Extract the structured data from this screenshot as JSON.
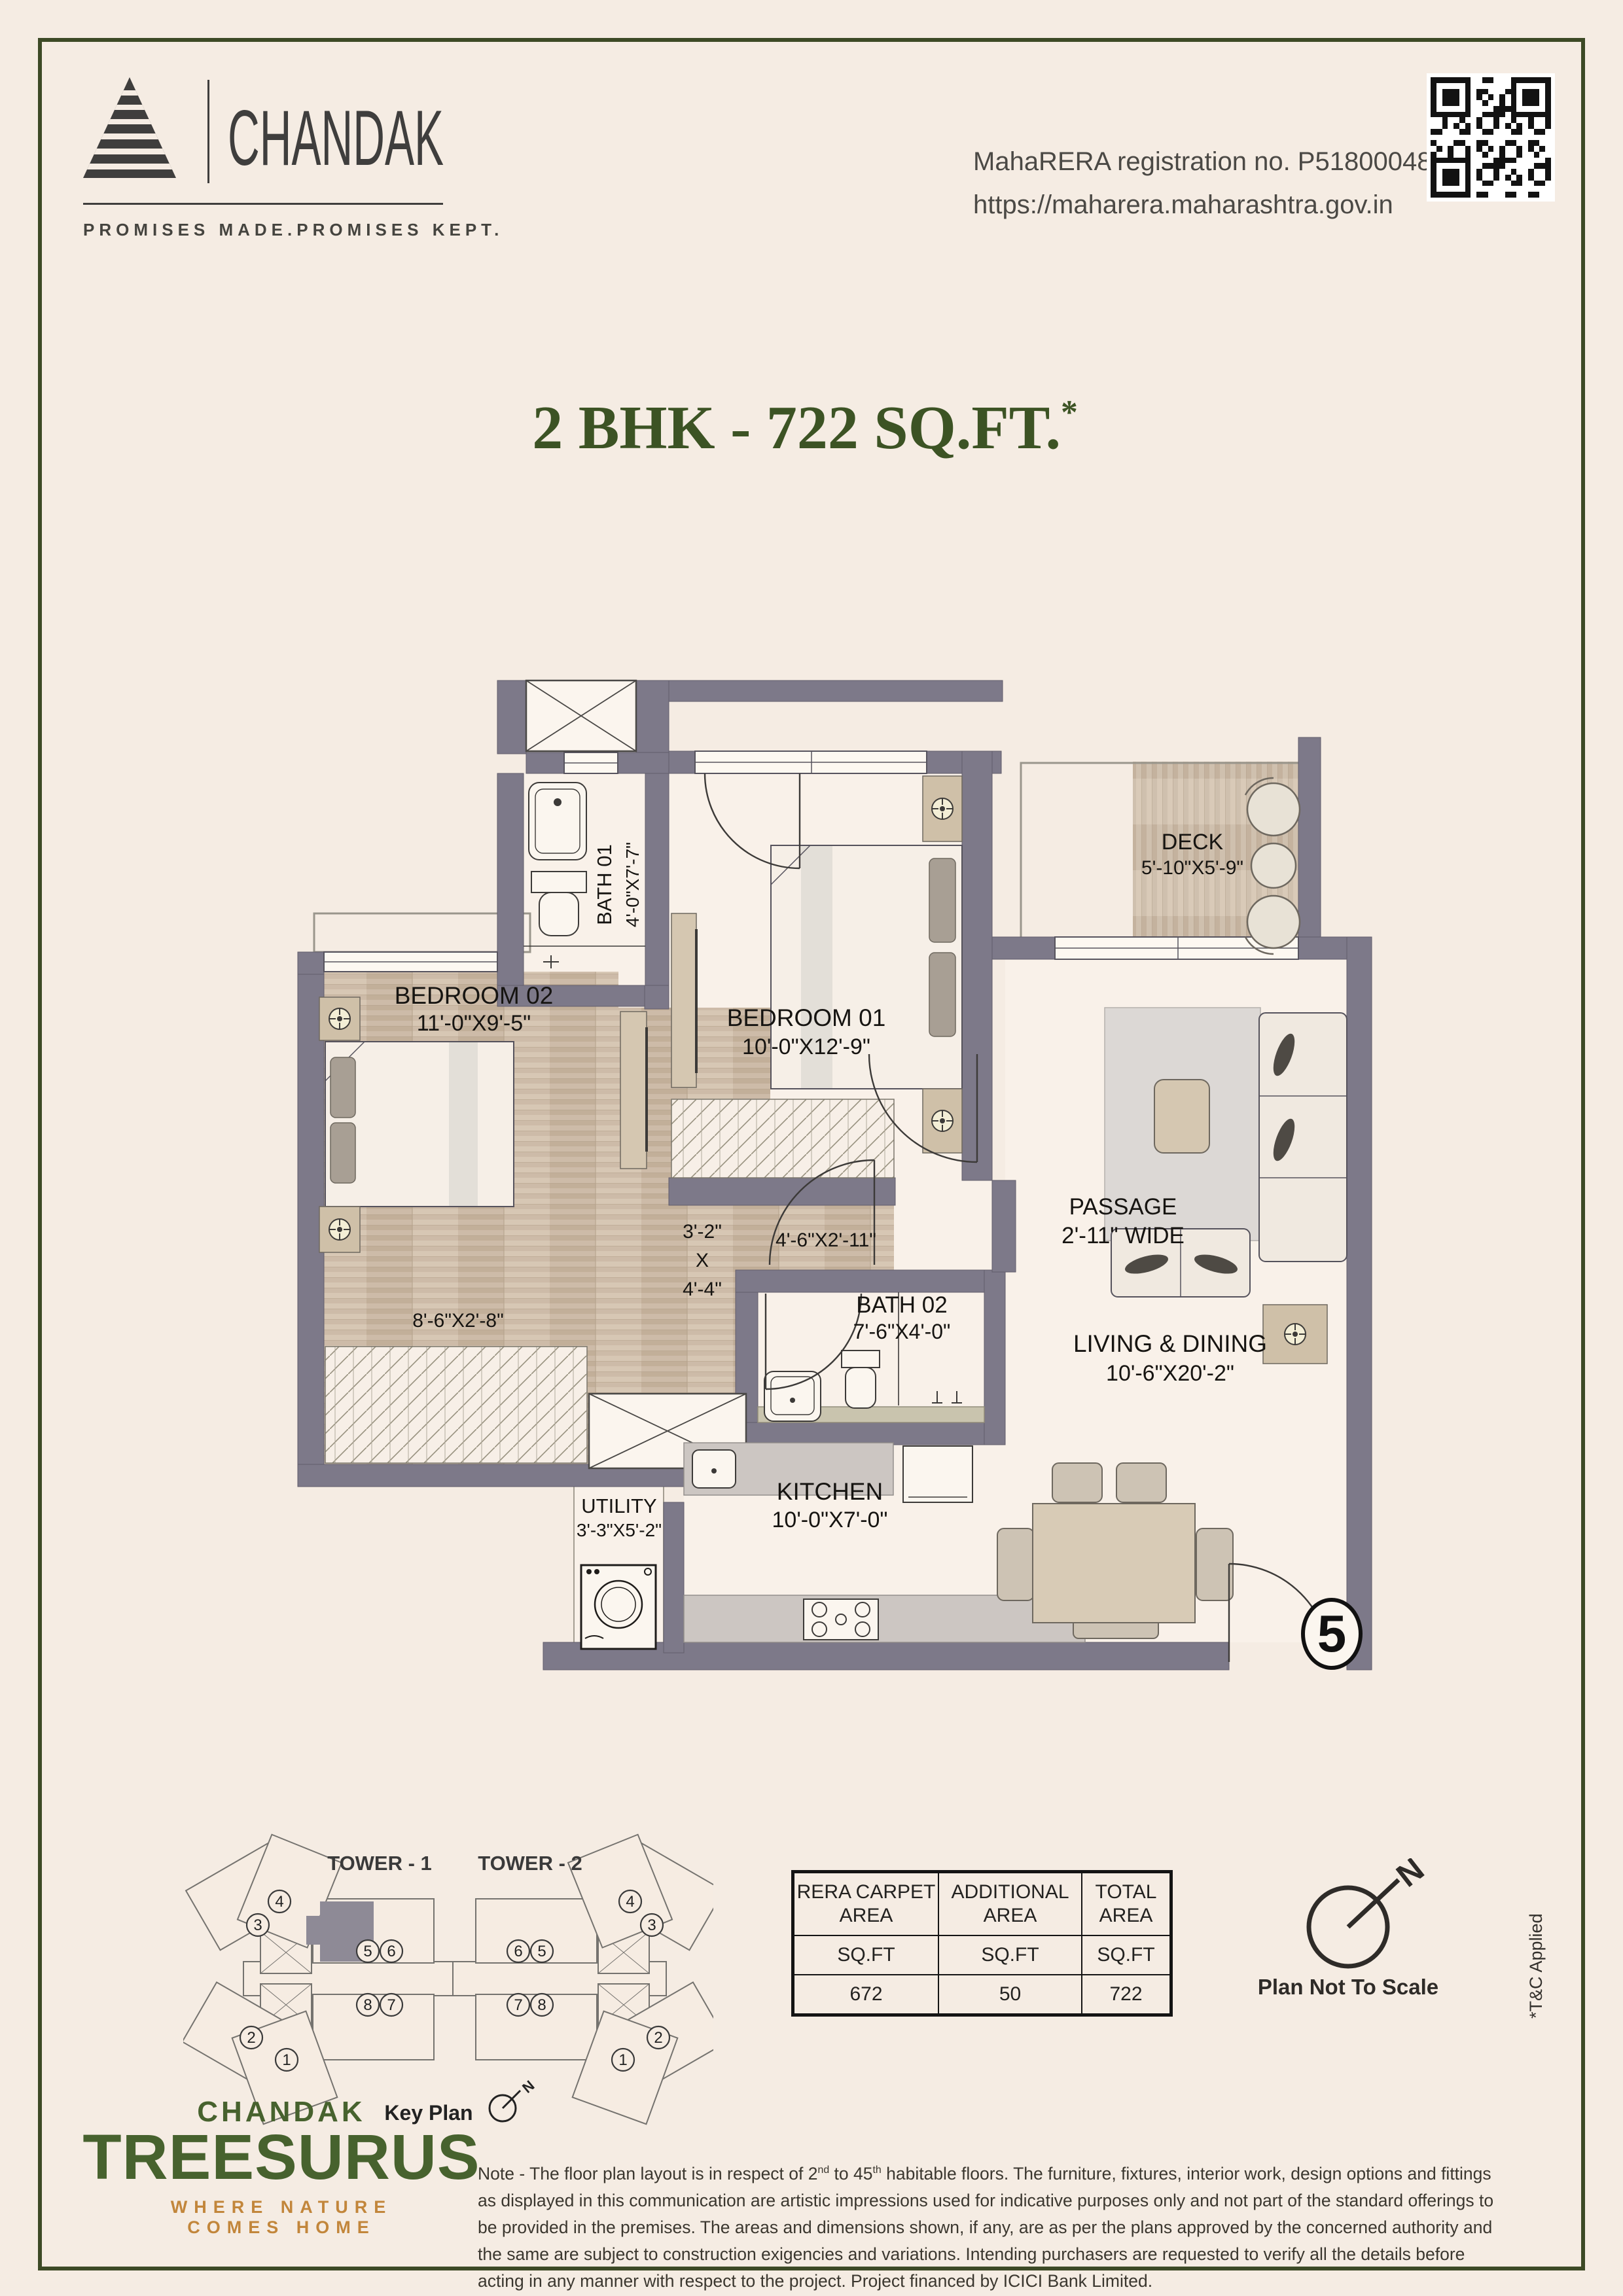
{
  "header": {
    "brand": {
      "name": "CHANDAK",
      "tagline": "PROMISES MADE.PROMISES KEPT."
    },
    "rera": {
      "line1": "MahaRERA registration no. P51800048658",
      "line2": "https://maharera.maharashtra.gov.in"
    }
  },
  "title": {
    "main": "2 BHK - 722 SQ.FT.",
    "asterisk": "*"
  },
  "plan": {
    "rooms": {
      "bedroom01": {
        "name": "BEDROOM 01",
        "dims": "10'-0\"X12'-9\""
      },
      "bedroom02": {
        "name": "BEDROOM 02",
        "dims": "11'-0\"X9'-5\""
      },
      "bath01": {
        "name": "BATH 01",
        "dims": "4'-0\"X7'-7\""
      },
      "bath02": {
        "name": "BATH 02",
        "dims": "7'-6\"X4'-0\""
      },
      "deck": {
        "name": "DECK",
        "dims": "5'-10\"X5'-9\""
      },
      "passage": {
        "name": "PASSAGE",
        "dims": "2'-11\" WIDE"
      },
      "living": {
        "name": "LIVING & DINING",
        "dims": "10'-6\"X20'-2\""
      },
      "kitchen": {
        "name": "KITCHEN",
        "dims": "10'-0\"X7'-0\""
      },
      "utility": {
        "name": "UTILITY",
        "dims": "3'-3\"X5'-2\""
      }
    },
    "dims": {
      "foyer_w": "3'-2\"",
      "foyer_x": "X",
      "foyer_h": "4'-4\"",
      "pass2": "4'-6\"X2'-11\"",
      "wardrobe": "8'-6\"X2'-8\""
    },
    "unit_number": "5"
  },
  "key_plan": {
    "tower1": "TOWER - 1",
    "tower2": "TOWER - 2",
    "label": "Key Plan",
    "north": "N",
    "t1": [
      "3",
      "4",
      "5",
      "6",
      "8",
      "7",
      "2",
      "1"
    ],
    "t2": [
      "6",
      "5",
      "7",
      "8",
      "4",
      "3",
      "2",
      "1"
    ]
  },
  "area_table": {
    "headers": [
      "RERA CARPET AREA",
      "ADDITIONAL AREA",
      "TOTAL AREA"
    ],
    "units": [
      "SQ.FT",
      "SQ.FT",
      "SQ.FT"
    ],
    "values": [
      "672",
      "50",
      "722"
    ]
  },
  "compass": {
    "north": "N",
    "note": "Plan Not To Scale"
  },
  "tnc": "*T&C Applied",
  "footer": {
    "brand_top": "CHANDAK",
    "brand_left": "TREES",
    "brand_right": "URUS",
    "tagline": "WHERE NATURE COMES HOME"
  },
  "note": {
    "p1": "Note - The floor plan layout is in respect of 2",
    "sup1": "nd",
    "p2": " to 45",
    "sup2": "th",
    "p3": " habitable floors. The furniture, fixtures, interior work, design options and fittings as displayed in this communication are artistic impressions used for indicative purposes only and not part of the standard offerings to be provided in the premises. The areas and dimensions shown, if any, are as per the plans approved by the concerned authority and the same are subject to construction exigencies and variations. Intending purchasers are requested to verify all the details before acting in any manner with respect to the project. Project financed by ICICI Bank Limited."
  },
  "colors": {
    "accent_green": "#3c5324",
    "brand_green": "#47622e",
    "brand_orange": "#c2863b",
    "wall": "#7d7989",
    "frame": "#3d4a26"
  }
}
